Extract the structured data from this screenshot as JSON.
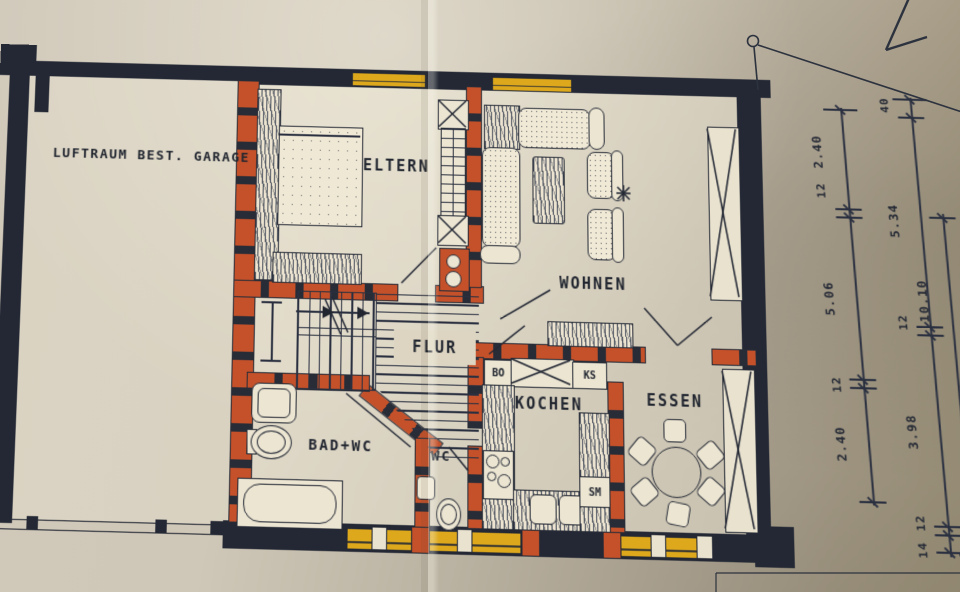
{
  "plan": {
    "garage_area_label": "LUFTRAUM BEST. GARAGE",
    "rooms": {
      "eltern": "ELTERN",
      "wohnen": "WOHNEN",
      "flur": "FLUR",
      "bad_wc": "BAD+WC",
      "wc": "WC",
      "kochen": "KOCHEN",
      "essen": "ESSEN"
    },
    "appliance_labels": {
      "oven": "BO",
      "fridge": "KS",
      "dishwasher": "SM"
    },
    "dimensions": {
      "inner_chain": [
        "2.40",
        "12",
        "5.06",
        "12",
        "2.40"
      ],
      "outer_chain": [
        "40",
        "5.34",
        "12",
        "3.98",
        "12",
        "14"
      ],
      "overall": "10.10"
    },
    "colors": {
      "exterior_wall": "#232834",
      "interior_wall": "#c4512a",
      "window_yellow": "#dda81c",
      "paper": "#c9c1b0",
      "ink": "#232834"
    }
  }
}
